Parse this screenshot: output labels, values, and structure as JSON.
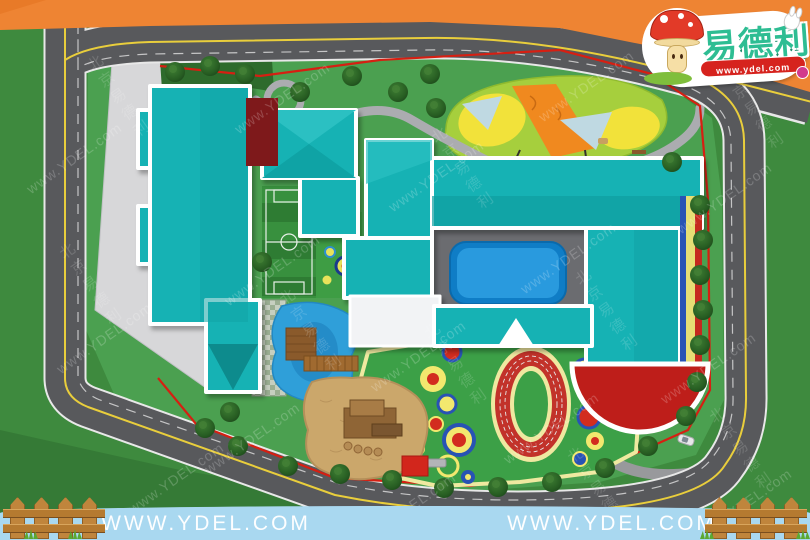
{
  "scene": {
    "type": "kindergarten-site-plan-render",
    "colors": {
      "sky_orange": "#EE8433",
      "grass_outer": "#3E8A3E",
      "grass_site": "#4BA050",
      "road_gray": "#58595C",
      "road_center_yellow": "#E9CE3C",
      "building_teal": "#18B2B4",
      "pool_blue": "#1E8FD8",
      "boundary_fence_red": "#D61F12",
      "track_red": "#C2322A",
      "track_lane_cream": "#EFE8A0",
      "plaza_gray": "#D7D7D9",
      "sand_tan": "#CBA76B",
      "canopy_lime": "#A6CF3D",
      "footer_blue": "#A9D8F0",
      "fence_wood": "#C0853C"
    },
    "features": [
      "ring-road",
      "teal-buildings",
      "swimming-pool",
      "soccer-field",
      "running-track",
      "play-circles",
      "sandbox",
      "pond-with-bridge",
      "canopy-garden",
      "red-half-court",
      "trees"
    ]
  },
  "logo": {
    "brand": "易德利",
    "url": "www.ydel.com",
    "mascot": "mushroom-character"
  },
  "footer": {
    "url": "WWW.YDEL.COM"
  },
  "watermark": {
    "latin": "www.YDEL.com",
    "cjk": "北京易德利"
  }
}
